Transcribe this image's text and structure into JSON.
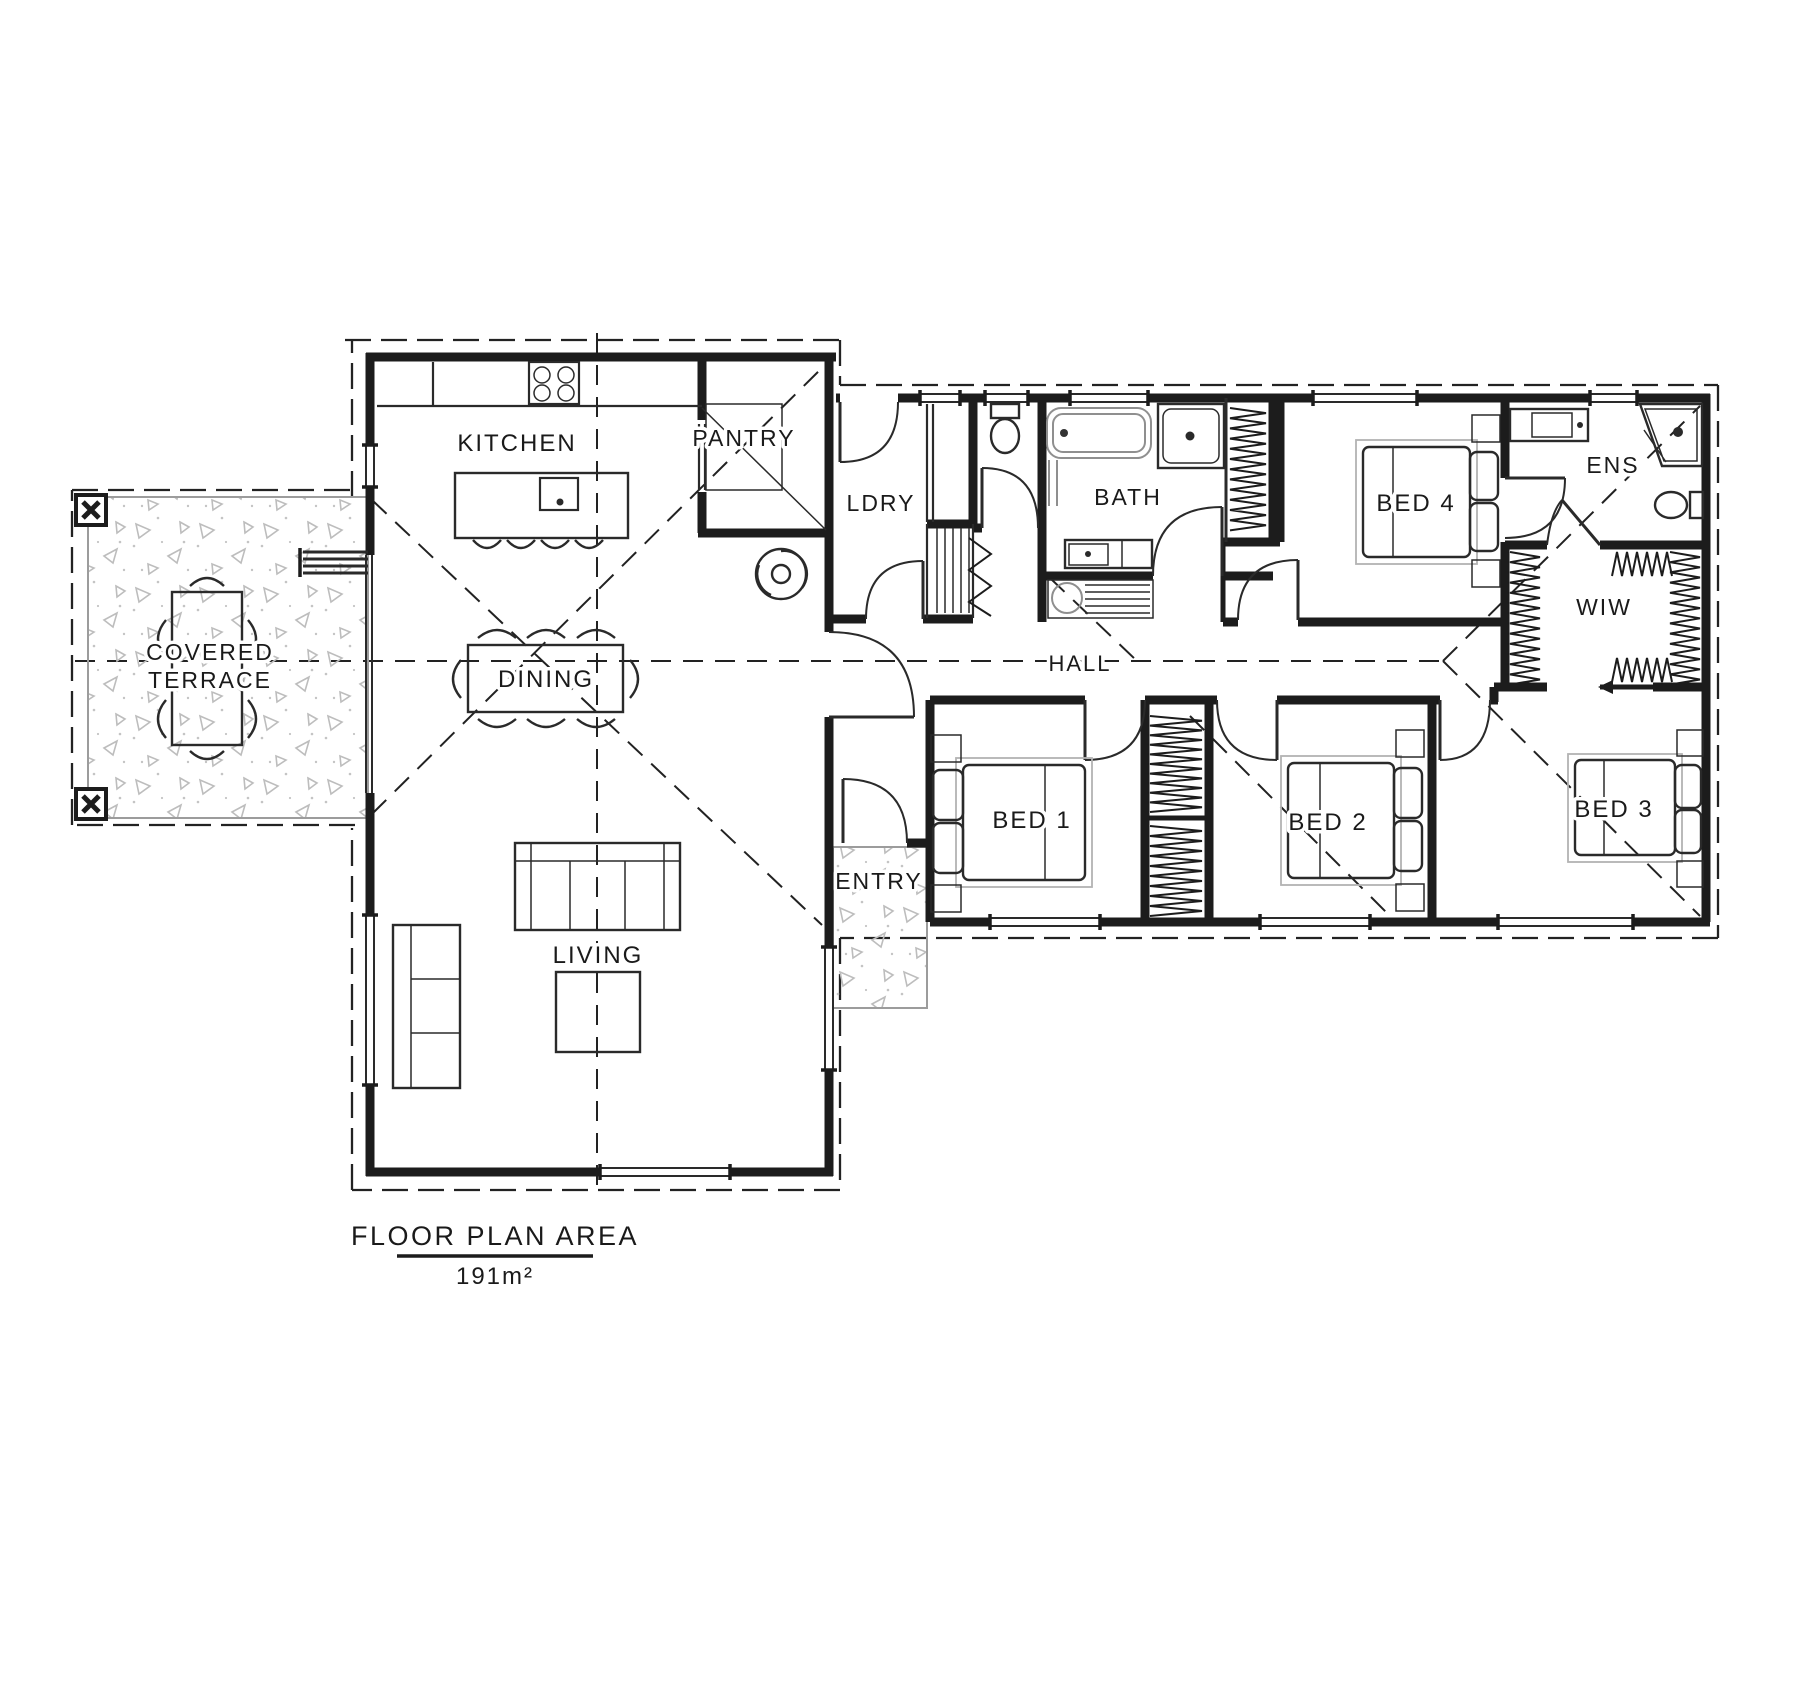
{
  "plan": {
    "title": "FLOOR PLAN AREA",
    "area": "191m²"
  },
  "rooms": {
    "kitchen": "KITCHEN",
    "pantry": "PANTRY",
    "laundry": "LDRY",
    "bath": "BATH",
    "bed4": "BED 4",
    "ens": "ENS",
    "wiw": "WIW",
    "hall": "HALL",
    "terrace1": "COVERED",
    "terrace2": "TERRACE",
    "dining": "DINING",
    "living": "LIVING",
    "entry": "ENTRY",
    "bed1": "BED 1",
    "bed2": "BED 2",
    "bed3": "BED 3"
  },
  "colors": {
    "ink": "#1c1c1c",
    "fixture_gray": "#8f8f8f",
    "concrete_fleck": "#bdbdbd",
    "paper": "#ffffff"
  }
}
